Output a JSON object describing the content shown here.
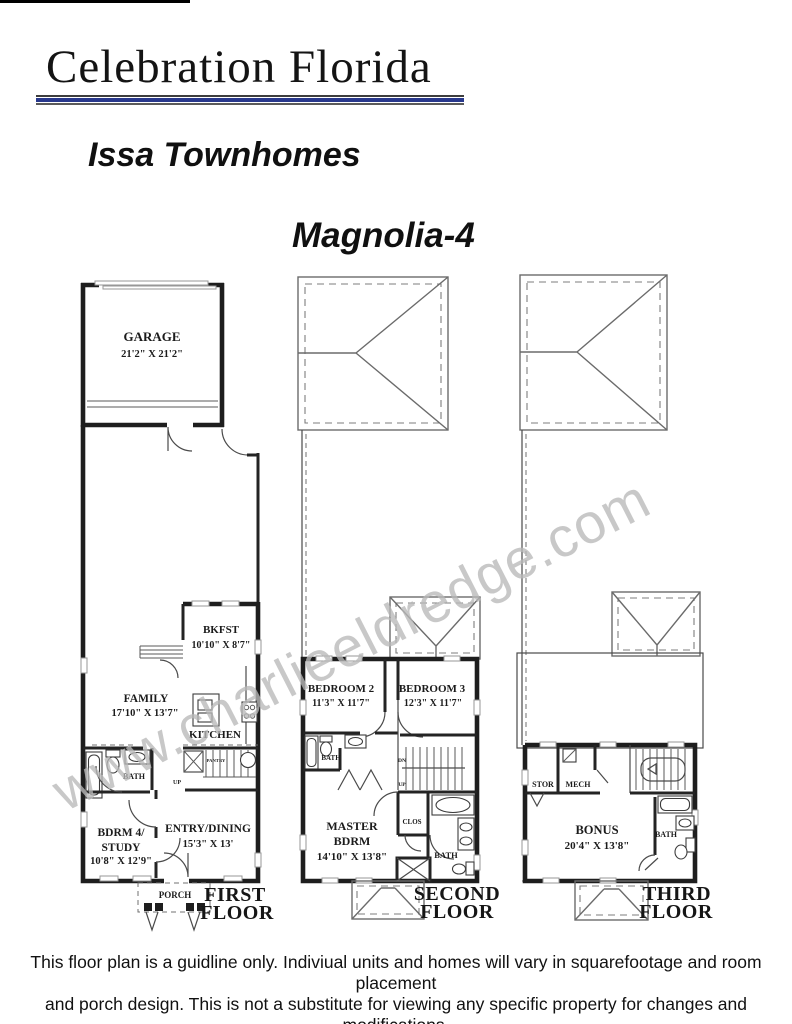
{
  "header": {
    "brand": "Celebration Florida",
    "community": "Issa Townhomes",
    "plan": "Magnolia-4",
    "accent_color": "#28388c"
  },
  "watermark": {
    "text": "www.charlieeldredge.com",
    "color": "#b9b9b9"
  },
  "floor1": {
    "title_line1": "FIRST",
    "title_line2": "FLOOR",
    "garage": {
      "label": "GARAGE",
      "dims": "21'2\" X 21'2\""
    },
    "bkfst": {
      "label": "BKFST",
      "dims": "10'10\" X 8'7\""
    },
    "family": {
      "label": "FAMILY",
      "dims": "17'10\" X 13'7\""
    },
    "kitchen": {
      "label": "KITCHEN"
    },
    "bath": {
      "label": "BATH"
    },
    "pantry": {
      "label": "PANTRY"
    },
    "up": "UP",
    "bdrm4": {
      "label_line1": "BDRM 4/",
      "label_line2": "STUDY",
      "dims": "10'8\" X 12'9\""
    },
    "entry": {
      "label": "ENTRY/DINING",
      "dims": "15'3\" X 13'"
    },
    "porch": {
      "label": "PORCH"
    }
  },
  "floor2": {
    "title_line1": "SECOND",
    "title_line2": "FLOOR",
    "bedroom2": {
      "label": "BEDROOM 2",
      "dims": "11'3\" X 11'7\""
    },
    "bedroom3": {
      "label": "BEDROOM 3",
      "dims": "12'3\" X 11'7\""
    },
    "bath_hall": {
      "label": "BATH"
    },
    "dn": "DN",
    "up": "UP",
    "clos": {
      "label": "CLOS"
    },
    "master": {
      "label_line1": "MASTER",
      "label_line2": "BDRM",
      "dims": "14'10\" X 13'8\""
    },
    "bath_master": {
      "label": "BATH"
    }
  },
  "floor3": {
    "title_line1": "THIRD",
    "title_line2": "FLOOR",
    "stor": {
      "label": "STOR"
    },
    "mech": {
      "label": "MECH"
    },
    "bonus": {
      "label": "BONUS",
      "dims": "20'4\" X 13'8\""
    },
    "bath": {
      "label": "BATH"
    }
  },
  "footer": {
    "line1": "This floor plan is a guidline only.  Indiviual units and homes will vary in squarefootage and room placement",
    "line2": "and porch design. This is not a substitute for viewing any specific property for changes and modifications."
  }
}
